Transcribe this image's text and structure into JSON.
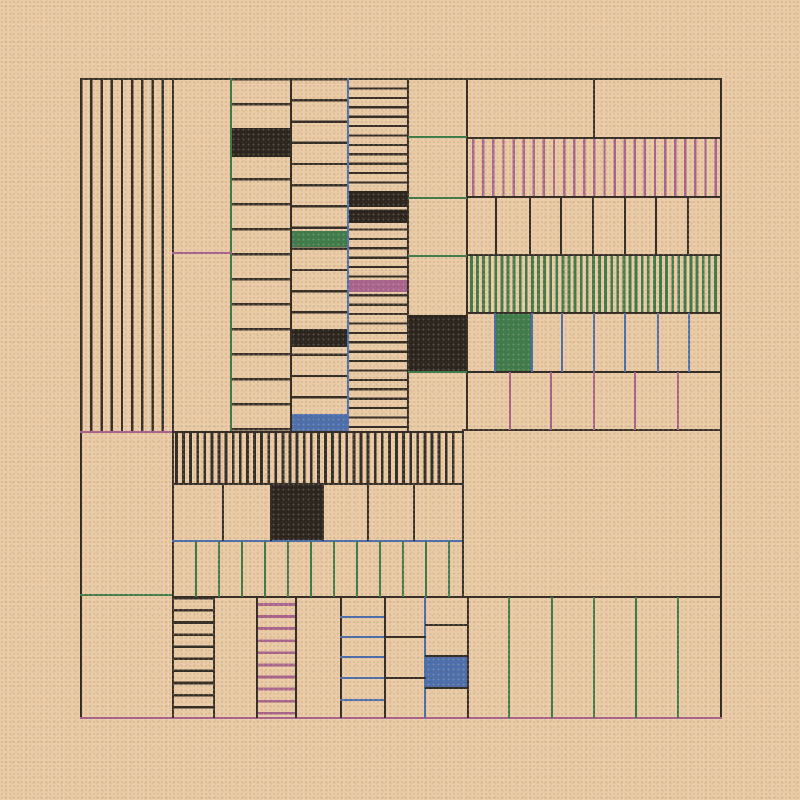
{
  "artwork": {
    "title": "generative-grid-composition",
    "canvas": {
      "width": 800,
      "height": 800
    },
    "palette": {
      "bg": "#e9cba6",
      "ink": "#332e27",
      "dark": "#2a251f",
      "green": "#3e7c4b",
      "mauve": "#a9648f",
      "blue": "#4c70ae"
    },
    "frame": {
      "x": 80,
      "y": 78,
      "w": 640,
      "h": 640
    },
    "elements": [
      {
        "name": "left-vstripe-panel",
        "kind": "stripes",
        "dir": "v",
        "x": 80,
        "y": 78,
        "w": 92,
        "h": 354,
        "period": 10.2,
        "lw": 2.4,
        "color": "ink"
      },
      {
        "name": "rows-panel-a",
        "kind": "stripes",
        "dir": "h",
        "x": 231,
        "y": 78,
        "w": 59,
        "h": 354,
        "period": 25,
        "lw": 2.4,
        "color": "ink"
      },
      {
        "name": "rows-panel-b",
        "kind": "stripes",
        "dir": "h",
        "x": 290,
        "y": 78,
        "w": 58,
        "h": 354,
        "period": 21.2,
        "lw": 2.4,
        "color": "ink"
      },
      {
        "name": "rows-panel-c",
        "kind": "stripes",
        "dir": "h",
        "x": 348,
        "y": 78,
        "w": 60,
        "h": 354,
        "period": 9.4,
        "lw": 2.2,
        "color": "ink"
      },
      {
        "name": "mauve-vstripe-band",
        "kind": "stripes",
        "dir": "v",
        "x": 467,
        "y": 138,
        "w": 253,
        "h": 59,
        "period": 10.1,
        "lw": 2.4,
        "offset": 5,
        "color": "mauve"
      },
      {
        "name": "green-vstripe-band",
        "kind": "stripes",
        "dir": "v",
        "x": 467,
        "y": 255,
        "w": 253,
        "h": 58,
        "period": 6.1,
        "lw": 2.8,
        "offset": 3,
        "color": "green"
      },
      {
        "name": "dense-vstripe-band",
        "kind": "stripes",
        "dir": "v",
        "x": 172,
        "y": 432,
        "w": 283,
        "h": 52,
        "period": 7.1,
        "lw": 2.8,
        "offset": 3,
        "color": "ink"
      },
      {
        "name": "black-hstripe-column",
        "kind": "stripes",
        "dir": "h",
        "x": 172,
        "y": 597,
        "w": 41,
        "h": 121,
        "period": 12.1,
        "lw": 2.6,
        "color": "ink"
      },
      {
        "name": "mauve-hstripe-column",
        "kind": "stripes",
        "dir": "h",
        "x": 257,
        "y": 597,
        "w": 38,
        "h": 121,
        "period": 12.1,
        "lw": 2.8,
        "offset": 6,
        "color": "mauve"
      },
      {
        "name": "black-cell",
        "kind": "solid",
        "x": 231,
        "y": 128,
        "w": 59,
        "h": 29,
        "color": "dark"
      },
      {
        "name": "green-cell",
        "kind": "solid",
        "x": 290,
        "y": 231,
        "w": 58,
        "h": 16,
        "color": "green"
      },
      {
        "name": "black-cell",
        "kind": "solid",
        "x": 290,
        "y": 329,
        "w": 58,
        "h": 18,
        "color": "dark"
      },
      {
        "name": "blue-cell",
        "kind": "solid",
        "x": 290,
        "y": 414,
        "w": 58,
        "h": 18,
        "color": "blue"
      },
      {
        "name": "black-cell",
        "kind": "solid",
        "x": 348,
        "y": 191,
        "w": 60,
        "h": 16,
        "color": "dark"
      },
      {
        "name": "black-cell",
        "kind": "solid",
        "x": 348,
        "y": 210,
        "w": 60,
        "h": 13,
        "color": "dark"
      },
      {
        "name": "mauve-cell",
        "kind": "solid",
        "x": 348,
        "y": 280,
        "w": 60,
        "h": 12,
        "color": "mauve"
      },
      {
        "name": "black-cell",
        "kind": "solid",
        "x": 408,
        "y": 315,
        "w": 59,
        "h": 56,
        "color": "dark"
      },
      {
        "name": "green-cell",
        "kind": "solid",
        "x": 496,
        "y": 313,
        "w": 36,
        "h": 59,
        "color": "green"
      },
      {
        "name": "black-cell",
        "kind": "solid",
        "x": 270,
        "y": 484,
        "w": 52,
        "h": 57,
        "color": "dark"
      },
      {
        "name": "blue-cell",
        "kind": "solid",
        "x": 425,
        "y": 656,
        "w": 43,
        "h": 32,
        "color": "blue"
      },
      {
        "name": "frame-border-top",
        "kind": "line",
        "x": 80,
        "y": 78,
        "w": 642,
        "h": 2.4,
        "color": "ink"
      },
      {
        "name": "frame-border-left",
        "kind": "line",
        "x": 80,
        "y": 78,
        "w": 2.4,
        "h": 640,
        "color": "ink"
      },
      {
        "name": "frame-border-right",
        "kind": "line",
        "x": 719.6,
        "y": 78,
        "w": 2.4,
        "h": 640,
        "color": "ink"
      },
      {
        "name": "frame-border-bottom-mauve",
        "kind": "line",
        "x": 80,
        "y": 716.6,
        "w": 642,
        "h": 2.8,
        "color": "mauve"
      },
      {
        "name": "divider-v",
        "kind": "line",
        "x": 172,
        "y": 78,
        "w": 2.4,
        "h": 640,
        "color": "ink"
      },
      {
        "name": "divider-v-green",
        "kind": "line",
        "x": 230,
        "y": 78,
        "w": 2.2,
        "h": 354,
        "color": "green"
      },
      {
        "name": "divider-v",
        "kind": "line",
        "x": 290,
        "y": 78,
        "w": 2.4,
        "h": 354,
        "color": "ink"
      },
      {
        "name": "divider-v-blue",
        "kind": "line",
        "x": 347,
        "y": 78,
        "w": 2.4,
        "h": 354,
        "color": "blue"
      },
      {
        "name": "divider-v",
        "kind": "line",
        "x": 407,
        "y": 78,
        "w": 2.4,
        "h": 354,
        "color": "ink"
      },
      {
        "name": "divider-v",
        "kind": "line",
        "x": 466,
        "y": 78,
        "w": 2.4,
        "h": 353,
        "color": "ink"
      },
      {
        "name": "divider-v",
        "kind": "line",
        "x": 593,
        "y": 78,
        "w": 2.4,
        "h": 61,
        "color": "ink"
      },
      {
        "name": "mauve-hline",
        "kind": "line",
        "x": 172,
        "y": 252,
        "w": 60,
        "h": 2.2,
        "color": "mauve"
      },
      {
        "name": "green-hline",
        "kind": "line",
        "x": 408,
        "y": 136,
        "w": 59,
        "h": 2.2,
        "color": "green"
      },
      {
        "name": "green-hline",
        "kind": "line",
        "x": 408,
        "y": 197,
        "w": 59,
        "h": 2.2,
        "color": "green"
      },
      {
        "name": "green-hline",
        "kind": "line",
        "x": 408,
        "y": 255,
        "w": 59,
        "h": 2.2,
        "color": "green"
      },
      {
        "name": "green-hline",
        "kind": "line",
        "x": 408,
        "y": 371,
        "w": 59,
        "h": 2.2,
        "color": "green"
      },
      {
        "name": "divider-h",
        "kind": "line",
        "x": 467,
        "y": 136.6,
        "w": 253,
        "h": 2.4,
        "color": "ink"
      },
      {
        "name": "divider-h",
        "kind": "line",
        "x": 467,
        "y": 196,
        "w": 253,
        "h": 2.4,
        "color": "ink"
      },
      {
        "name": "divider-h",
        "kind": "line",
        "x": 467,
        "y": 254,
        "w": 253,
        "h": 2.4,
        "color": "ink"
      },
      {
        "name": "divider-h",
        "kind": "line",
        "x": 467,
        "y": 312,
        "w": 253,
        "h": 2.4,
        "color": "ink"
      },
      {
        "name": "divider-h",
        "kind": "line",
        "x": 467,
        "y": 370.6,
        "w": 253,
        "h": 2.4,
        "color": "ink"
      },
      {
        "name": "divider-h",
        "kind": "line",
        "x": 462,
        "y": 429,
        "w": 258,
        "h": 2.4,
        "color": "ink"
      },
      {
        "name": "cell-divider",
        "kind": "line",
        "x": 495,
        "y": 197,
        "w": 2.4,
        "h": 58,
        "color": "ink"
      },
      {
        "name": "cell-divider",
        "kind": "line",
        "x": 529,
        "y": 197,
        "w": 2.4,
        "h": 58,
        "color": "ink"
      },
      {
        "name": "cell-divider",
        "kind": "line",
        "x": 560,
        "y": 197,
        "w": 2.4,
        "h": 58,
        "color": "ink"
      },
      {
        "name": "cell-divider",
        "kind": "line",
        "x": 592,
        "y": 197,
        "w": 2.4,
        "h": 58,
        "color": "ink"
      },
      {
        "name": "cell-divider",
        "kind": "line",
        "x": 624,
        "y": 197,
        "w": 2.4,
        "h": 58,
        "color": "ink"
      },
      {
        "name": "cell-divider",
        "kind": "line",
        "x": 655,
        "y": 197,
        "w": 2.4,
        "h": 58,
        "color": "ink"
      },
      {
        "name": "cell-divider",
        "kind": "line",
        "x": 687,
        "y": 197,
        "w": 2.4,
        "h": 58,
        "color": "ink"
      },
      {
        "name": "cell-divider-blue",
        "kind": "line",
        "x": 494,
        "y": 313,
        "w": 2.4,
        "h": 59,
        "color": "blue"
      },
      {
        "name": "cell-divider-blue",
        "kind": "line",
        "x": 531,
        "y": 313,
        "w": 2.4,
        "h": 59,
        "color": "blue"
      },
      {
        "name": "cell-divider-blue",
        "kind": "line",
        "x": 561,
        "y": 313,
        "w": 2.4,
        "h": 59,
        "color": "blue"
      },
      {
        "name": "cell-divider-blue",
        "kind": "line",
        "x": 593,
        "y": 313,
        "w": 2.4,
        "h": 59,
        "color": "blue"
      },
      {
        "name": "cell-divider-blue",
        "kind": "line",
        "x": 624,
        "y": 313,
        "w": 2.4,
        "h": 59,
        "color": "blue"
      },
      {
        "name": "cell-divider-blue",
        "kind": "line",
        "x": 657,
        "y": 313,
        "w": 2.4,
        "h": 59,
        "color": "blue"
      },
      {
        "name": "cell-divider-blue",
        "kind": "line",
        "x": 688,
        "y": 313,
        "w": 2.4,
        "h": 59,
        "color": "blue"
      },
      {
        "name": "cell-divider-mauve",
        "kind": "line",
        "x": 509,
        "y": 372,
        "w": 2.2,
        "h": 58,
        "color": "mauve"
      },
      {
        "name": "cell-divider-mauve",
        "kind": "line",
        "x": 550,
        "y": 372,
        "w": 2.2,
        "h": 58,
        "color": "mauve"
      },
      {
        "name": "cell-divider-mauve",
        "kind": "line",
        "x": 593,
        "y": 372,
        "w": 2.2,
        "h": 58,
        "color": "mauve"
      },
      {
        "name": "cell-divider-mauve",
        "kind": "line",
        "x": 634,
        "y": 372,
        "w": 2.2,
        "h": 58,
        "color": "mauve"
      },
      {
        "name": "cell-divider-mauve",
        "kind": "line",
        "x": 677,
        "y": 372,
        "w": 2.2,
        "h": 58,
        "color": "mauve"
      },
      {
        "name": "mauve-hline",
        "kind": "line",
        "x": 80,
        "y": 431,
        "w": 92,
        "h": 2.4,
        "color": "mauve"
      },
      {
        "name": "divider-h",
        "kind": "line",
        "x": 172,
        "y": 431,
        "w": 291,
        "h": 2.4,
        "color": "ink"
      },
      {
        "name": "divider-h",
        "kind": "line",
        "x": 172,
        "y": 483,
        "w": 291,
        "h": 2.4,
        "color": "ink"
      },
      {
        "name": "divider-h-blue",
        "kind": "line",
        "x": 172,
        "y": 540,
        "w": 291,
        "h": 2.4,
        "color": "blue"
      },
      {
        "name": "green-hline",
        "kind": "line",
        "x": 80,
        "y": 594,
        "w": 92,
        "h": 2.2,
        "color": "green"
      },
      {
        "name": "divider-h",
        "kind": "line",
        "x": 172,
        "y": 596,
        "w": 548,
        "h": 2.4,
        "color": "ink"
      },
      {
        "name": "divider-v",
        "kind": "line",
        "x": 462,
        "y": 429,
        "w": 2.4,
        "h": 169,
        "color": "ink"
      },
      {
        "name": "cell-divider",
        "kind": "line",
        "x": 222,
        "y": 484,
        "w": 2.4,
        "h": 57,
        "color": "ink"
      },
      {
        "name": "cell-divider",
        "kind": "line",
        "x": 270,
        "y": 484,
        "w": 2.4,
        "h": 57,
        "color": "ink"
      },
      {
        "name": "cell-divider",
        "kind": "line",
        "x": 322,
        "y": 484,
        "w": 2.4,
        "h": 57,
        "color": "ink"
      },
      {
        "name": "cell-divider",
        "kind": "line",
        "x": 367,
        "y": 484,
        "w": 2.4,
        "h": 57,
        "color": "ink"
      },
      {
        "name": "cell-divider",
        "kind": "line",
        "x": 413,
        "y": 484,
        "w": 2.4,
        "h": 57,
        "color": "ink"
      },
      {
        "name": "cell-divider-green",
        "kind": "line",
        "x": 195,
        "y": 541,
        "w": 2.2,
        "h": 56,
        "color": "green"
      },
      {
        "name": "cell-divider-green",
        "kind": "line",
        "x": 218,
        "y": 541,
        "w": 2.2,
        "h": 56,
        "color": "green"
      },
      {
        "name": "cell-divider-green",
        "kind": "line",
        "x": 241,
        "y": 541,
        "w": 2.2,
        "h": 56,
        "color": "green"
      },
      {
        "name": "cell-divider-green",
        "kind": "line",
        "x": 264,
        "y": 541,
        "w": 2.2,
        "h": 56,
        "color": "green"
      },
      {
        "name": "cell-divider-green",
        "kind": "line",
        "x": 287,
        "y": 541,
        "w": 2.2,
        "h": 56,
        "color": "green"
      },
      {
        "name": "cell-divider-green",
        "kind": "line",
        "x": 310,
        "y": 541,
        "w": 2.2,
        "h": 56,
        "color": "green"
      },
      {
        "name": "cell-divider-green",
        "kind": "line",
        "x": 333,
        "y": 541,
        "w": 2.2,
        "h": 56,
        "color": "green"
      },
      {
        "name": "cell-divider-green",
        "kind": "line",
        "x": 356,
        "y": 541,
        "w": 2.2,
        "h": 56,
        "color": "green"
      },
      {
        "name": "cell-divider-green",
        "kind": "line",
        "x": 379,
        "y": 541,
        "w": 2.2,
        "h": 56,
        "color": "green"
      },
      {
        "name": "cell-divider-green",
        "kind": "line",
        "x": 402,
        "y": 541,
        "w": 2.2,
        "h": 56,
        "color": "green"
      },
      {
        "name": "cell-divider-green",
        "kind": "line",
        "x": 425,
        "y": 541,
        "w": 2.2,
        "h": 56,
        "color": "green"
      },
      {
        "name": "cell-divider-green",
        "kind": "line",
        "x": 448,
        "y": 541,
        "w": 2.2,
        "h": 56,
        "color": "green"
      },
      {
        "name": "divider-v",
        "kind": "line",
        "x": 213,
        "y": 597,
        "w": 2.4,
        "h": 121,
        "color": "ink"
      },
      {
        "name": "divider-v",
        "kind": "line",
        "x": 256,
        "y": 597,
        "w": 2.4,
        "h": 121,
        "color": "ink"
      },
      {
        "name": "divider-v",
        "kind": "line",
        "x": 295,
        "y": 597,
        "w": 2.4,
        "h": 121,
        "color": "ink"
      },
      {
        "name": "divider-v",
        "kind": "line",
        "x": 340,
        "y": 597,
        "w": 2.4,
        "h": 121,
        "color": "ink"
      },
      {
        "name": "divider-v",
        "kind": "line",
        "x": 384,
        "y": 597,
        "w": 2.4,
        "h": 121,
        "color": "ink"
      },
      {
        "name": "divider-v-blue",
        "kind": "line",
        "x": 424,
        "y": 597,
        "w": 2.4,
        "h": 121,
        "color": "blue"
      },
      {
        "name": "divider-v",
        "kind": "line",
        "x": 467,
        "y": 597,
        "w": 2.4,
        "h": 121,
        "color": "ink"
      },
      {
        "name": "blue-hline",
        "kind": "line",
        "x": 340,
        "y": 616,
        "w": 44,
        "h": 2.2,
        "color": "blue"
      },
      {
        "name": "blue-hline",
        "kind": "line",
        "x": 340,
        "y": 636,
        "w": 44,
        "h": 2.2,
        "color": "blue"
      },
      {
        "name": "blue-hline",
        "kind": "line",
        "x": 340,
        "y": 656,
        "w": 44,
        "h": 2.2,
        "color": "blue"
      },
      {
        "name": "blue-hline",
        "kind": "line",
        "x": 340,
        "y": 677,
        "w": 44,
        "h": 2.2,
        "color": "blue"
      },
      {
        "name": "blue-hline",
        "kind": "line",
        "x": 340,
        "y": 699,
        "w": 44,
        "h": 2.2,
        "color": "blue"
      },
      {
        "name": "divider-h",
        "kind": "line",
        "x": 384,
        "y": 636,
        "w": 42,
        "h": 2.4,
        "color": "ink"
      },
      {
        "name": "divider-h",
        "kind": "line",
        "x": 384,
        "y": 677,
        "w": 42,
        "h": 2.4,
        "color": "ink"
      },
      {
        "name": "divider-h",
        "kind": "line",
        "x": 425,
        "y": 624,
        "w": 43,
        "h": 2.4,
        "color": "ink"
      },
      {
        "name": "divider-h",
        "kind": "line",
        "x": 425,
        "y": 655,
        "w": 43,
        "h": 2.4,
        "color": "ink"
      },
      {
        "name": "divider-h",
        "kind": "line",
        "x": 425,
        "y": 687,
        "w": 43,
        "h": 2.4,
        "color": "ink"
      },
      {
        "name": "cell-divider-green",
        "kind": "line",
        "x": 508,
        "y": 597,
        "w": 2.2,
        "h": 121,
        "color": "green"
      },
      {
        "name": "cell-divider-green",
        "kind": "line",
        "x": 551,
        "y": 597,
        "w": 2.2,
        "h": 121,
        "color": "green"
      },
      {
        "name": "cell-divider-green",
        "kind": "line",
        "x": 593,
        "y": 597,
        "w": 2.2,
        "h": 121,
        "color": "green"
      },
      {
        "name": "cell-divider-green",
        "kind": "line",
        "x": 635,
        "y": 597,
        "w": 2.2,
        "h": 121,
        "color": "green"
      },
      {
        "name": "cell-divider-green",
        "kind": "line",
        "x": 677,
        "y": 597,
        "w": 2.2,
        "h": 121,
        "color": "green"
      }
    ]
  }
}
